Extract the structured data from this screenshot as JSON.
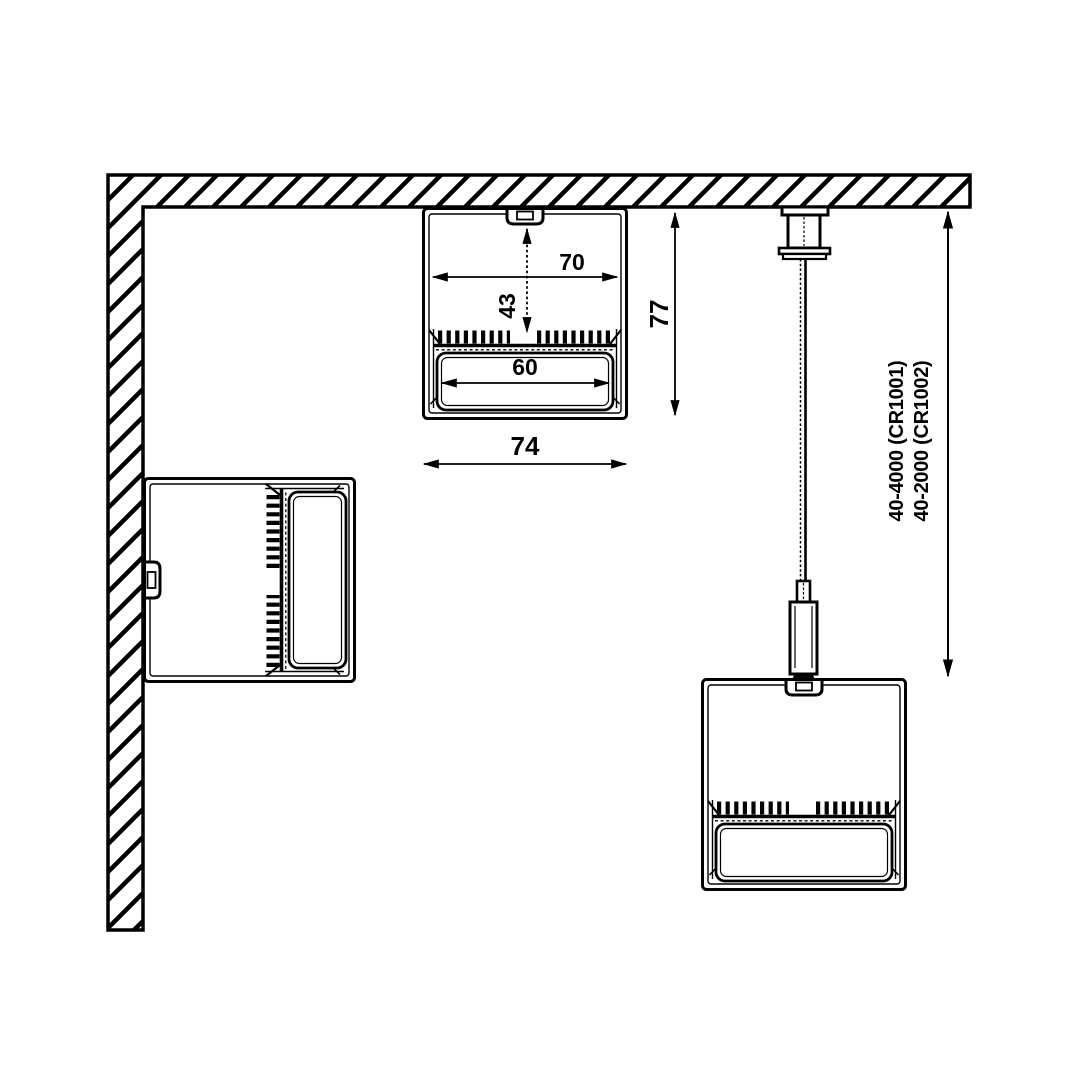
{
  "canvas": {
    "background": "#ffffff",
    "ink": "#000000"
  },
  "drawing": {
    "type": "technical-cross-section",
    "labels": {
      "inner_width": "70",
      "depth_to_led": "43",
      "diffuser_width": "60",
      "overall_width": "74",
      "overall_height": "77",
      "suspension_range_1": "40-4000 (CR1001)",
      "suspension_range_2": "40-2000 (CR1002)"
    }
  }
}
